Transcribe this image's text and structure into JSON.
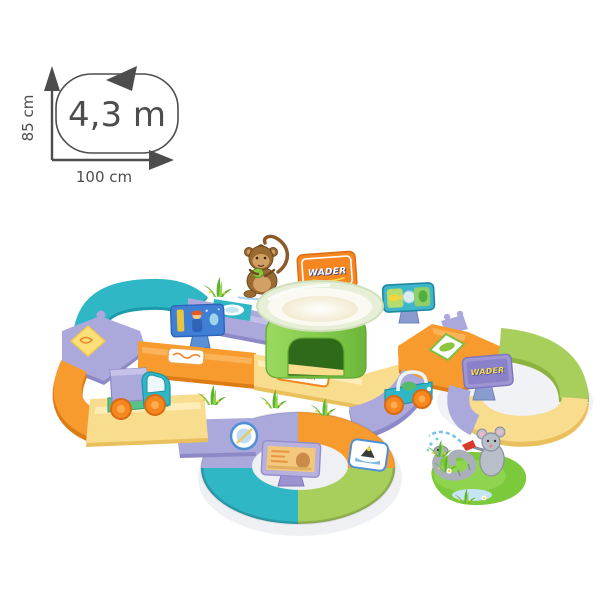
{
  "page": {
    "background_color": "#ffffff"
  },
  "dimension_diagram": {
    "track_length": "4,3 m",
    "height": "85 cm",
    "width": "100 cm"
  },
  "playset": {
    "brand": "WADER",
    "signs": {
      "top_billboard_label": "WADER",
      "right_billboard_label": "WADER",
      "road_sticker_label": "WADER"
    },
    "elements": [
      "monkey-illustration",
      "mouse-with-hose-illustration",
      "grass-tufts",
      "funnel-tower",
      "toy-truck",
      "toy-jeep",
      "aquarium-billboard",
      "fish-billboard",
      "picture-billboard"
    ]
  },
  "palette": {
    "page_bg": "#ffffff",
    "ink": "#4d4d4d",
    "teal": "#2fb7c5",
    "teal_dark": "#1b9aaa",
    "purple": "#aba8db",
    "purple_dark": "#8d89c6",
    "orange": "#f79b2f",
    "orange_dark": "#dd7c14",
    "yellow": "#f9dd8e",
    "yellow_dark": "#e9c05c",
    "green": "#a8cf5b",
    "green_dark": "#8cb23f",
    "tower_green": "#8ed05c",
    "tower_green_dark": "#4f9427",
    "sign_orange": "#f6861f",
    "sign_purple": "#9d96d3",
    "post_blue": "#8a9bd0",
    "brand_navy": "#1e3e8f",
    "brand_yellow": "#ffd94d",
    "marine_blue": "#3f7fd4",
    "grass_green": "#5cb032",
    "grass_light": "#90d44b",
    "patch_green": "#7cc93c",
    "mouse_gray": "#b9bfc9",
    "monkey_brown": "#9a6a33",
    "monkey_tan": "#d2a063",
    "wheel_orange": "#f6861f",
    "water_blue": "#7fc0ee"
  }
}
